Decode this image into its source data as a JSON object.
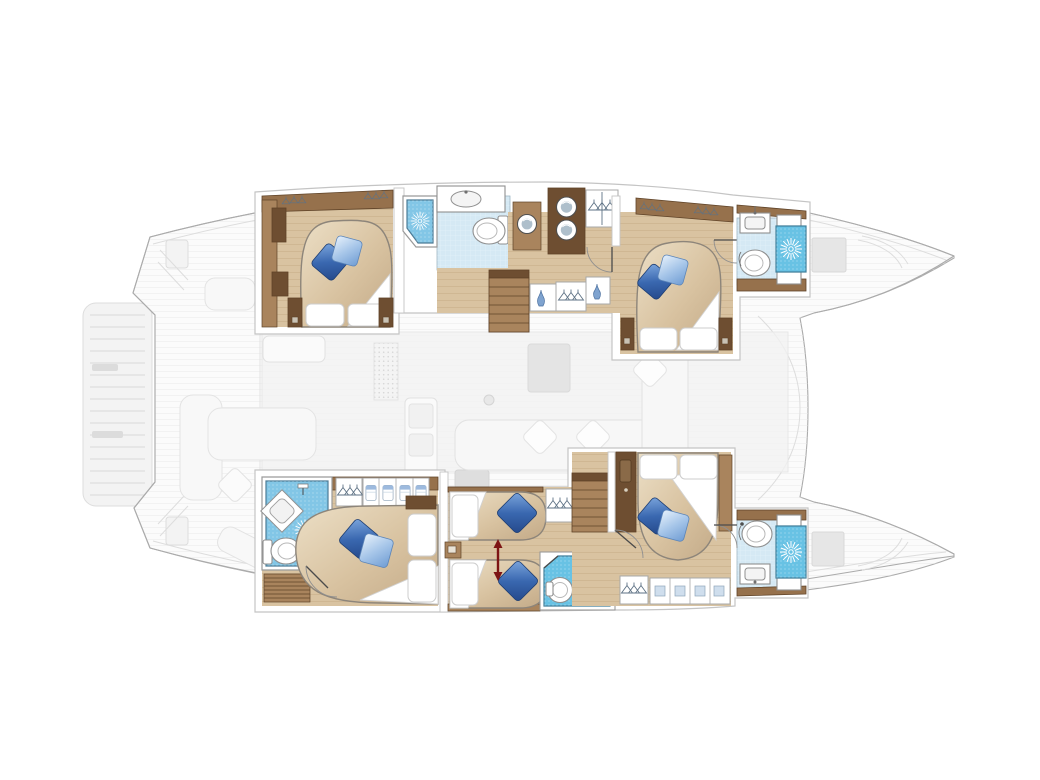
{
  "meta": {
    "title": "Catamaran yacht interior deck plan — top-down layout",
    "description": "Top-down floor plan of a sailing catamaran. Bow points right. Both hulls show furnished guest cabins with island double beds, a twin cabin, wardrobes, stairs and en-suite bathrooms with showers, toilets and sinks. The central salon, aft cockpit, swim platform and bow trampoline are ghosted in light grey.",
    "view": "top-down",
    "bow_direction": "right"
  },
  "palette": {
    "frame_line": "#c4c4c4",
    "ghost_fill": "#f3f3f3",
    "ghost_line": "#dddddd",
    "ghost_line_dark": "#ababab",
    "deck_fill": "#fbfbfb",
    "deck_stripe": "#ececec",
    "salon_tint": "#f1f1f1",
    "wood_wall": "#96714c",
    "wood_dark": "#6e4e31",
    "wood_mid": "#a9845d",
    "wood_floor": "#d9c3a1",
    "wood_line": "#5f4328",
    "plank_line": "#b99c74",
    "duvet_light": "#ead9bd",
    "duvet_dark": "#c7ae8c",
    "pillow_blue_dark": "#2e5ca3",
    "pillow_blue_mid": "#6f9fd8",
    "pillow_blue_light": "#cfe2f6",
    "bath_floor": "#d5e9f4",
    "shower_blue": "#82c6e6",
    "shower_bright": "#68c2e4",
    "fixture_line": "#8f8f8f",
    "red_arrow": "#7d1414",
    "hanger_color": "#64798c"
  },
  "hulls": [
    {
      "id": "port-hull",
      "position": "top",
      "rooms": [
        {
          "name": "aft-double-cabin",
          "features": [
            "island-double-bed",
            "white-pillows",
            "blue-throw-pillows",
            "wardrobes",
            "nightstands"
          ]
        },
        {
          "name": "aft-bathroom",
          "features": [
            "corner-shower",
            "sink",
            "toilet",
            "door-swing"
          ]
        },
        {
          "name": "companionway-corridor",
          "features": [
            "washer-dryer-stack",
            "appliance",
            "hanging-wardrobe",
            "storage-cubbies",
            "stairs-to-salon"
          ]
        },
        {
          "name": "forward-double-cabin",
          "features": [
            "island-double-bed",
            "white-pillows",
            "blue-throw-pillows",
            "wardrobes",
            "nightstands"
          ]
        },
        {
          "name": "bow-bathroom",
          "features": [
            "sink",
            "toilet",
            "shower",
            "door-swing"
          ]
        }
      ]
    },
    {
      "id": "starboard-hull",
      "position": "bottom",
      "rooms": [
        {
          "name": "aft-double-cabin",
          "features": [
            "island-double-bed",
            "corner-shower",
            "diamond-sink",
            "toilet",
            "hanging-wardrobe",
            "shirt-cubbies",
            "slatted-bench"
          ]
        },
        {
          "name": "twin-cabin",
          "features": [
            "two-single-beds",
            "convertible-beds-red-arrow",
            "nightstand",
            "hanging-wardrobe"
          ]
        },
        {
          "name": "mid-bathroom",
          "features": [
            "shower-floor",
            "toilet",
            "sink",
            "door-swing"
          ]
        },
        {
          "name": "forward-double-cabin",
          "features": [
            "island-double-bed",
            "stairs-to-salon",
            "tall-cabinet",
            "wardrobe-shelves"
          ]
        },
        {
          "name": "bow-bathroom",
          "features": [
            "toilet",
            "sink",
            "shower",
            "door-swing"
          ]
        }
      ]
    }
  ],
  "shared_areas": [
    {
      "name": "salon",
      "state": "ghosted",
      "features": [
        "l-shaped-sofa",
        "throw-cushions",
        "table",
        "galley-island",
        "galley-counter",
        "dotted-mat",
        "mast-post"
      ]
    },
    {
      "name": "aft-cockpit",
      "state": "ghosted",
      "features": [
        "bench-seats",
        "cushion"
      ]
    },
    {
      "name": "swim-platform",
      "state": "ghosted",
      "features": [
        "teak-slats"
      ]
    },
    {
      "name": "stern-steps",
      "state": "ghosted"
    },
    {
      "name": "foredeck-and-trampoline",
      "state": "ghosted",
      "features": [
        "deck-hatches"
      ]
    }
  ],
  "legend_icons": [
    "shower-starburst-drain",
    "toilet-icon",
    "sink-icon",
    "hanger-icon",
    "washer-dryer-icon",
    "folded-shirt-icon",
    "stairs-icon",
    "door-swing-arc",
    "convertible-bed-arrow"
  ]
}
